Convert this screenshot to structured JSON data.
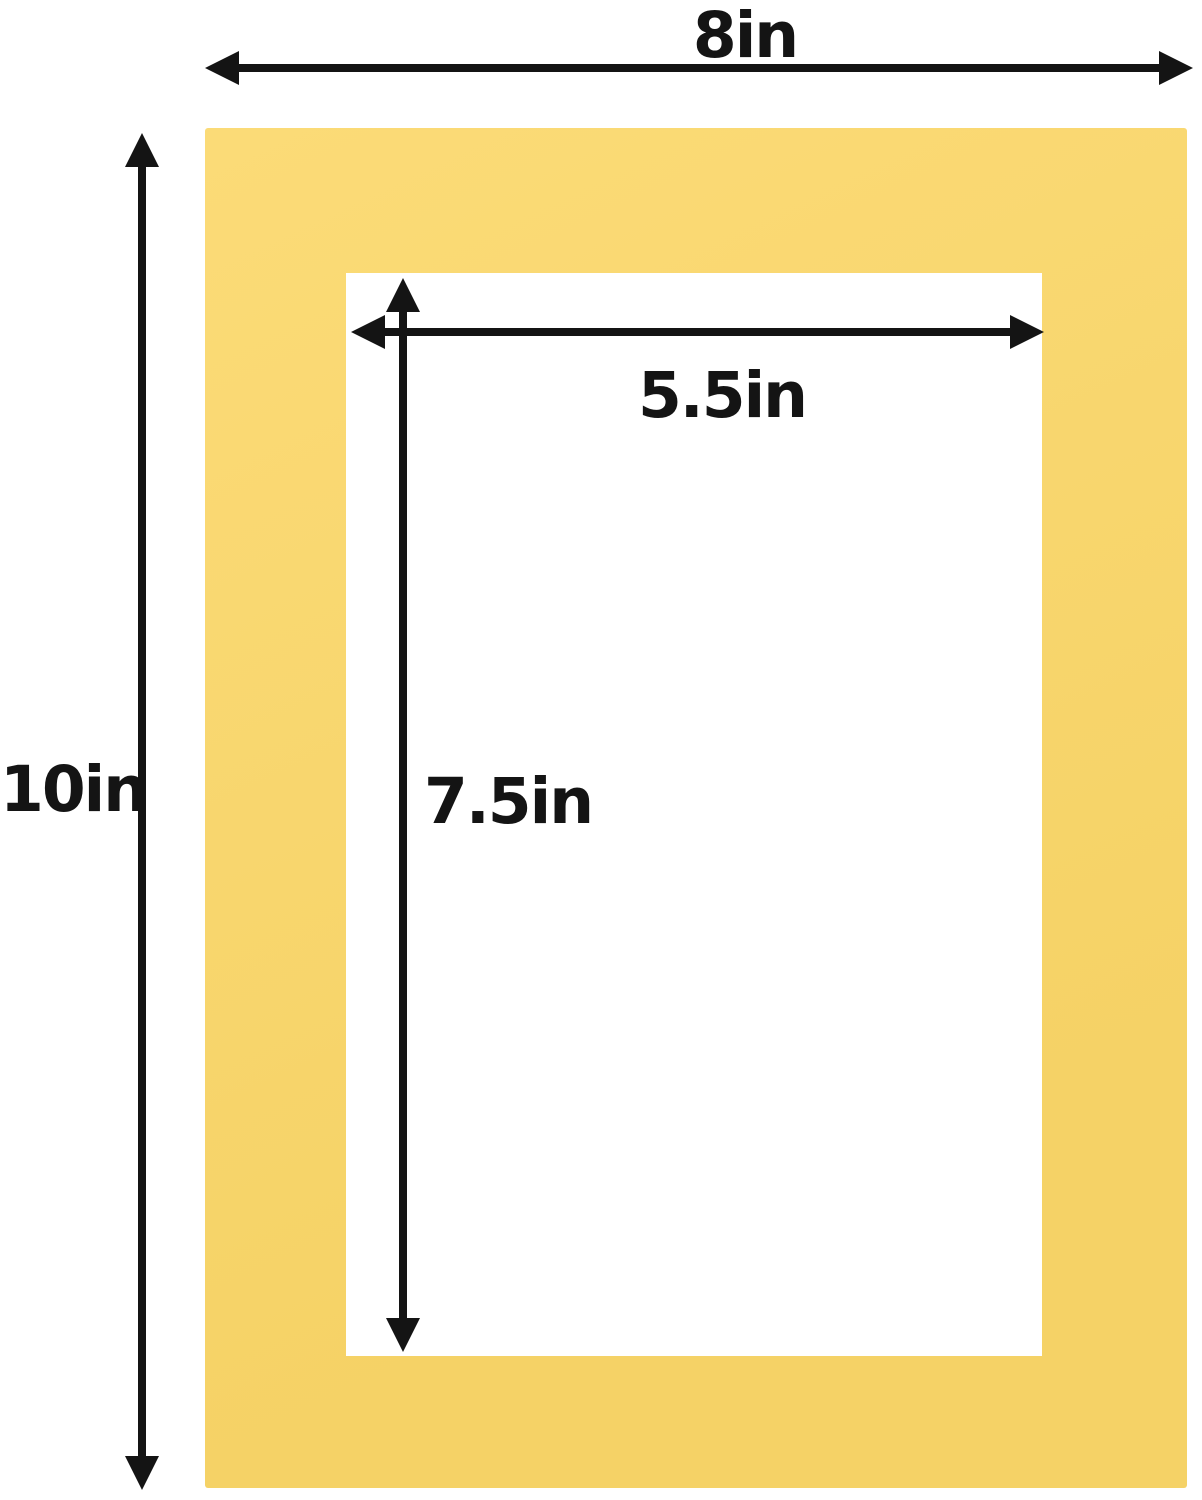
{
  "colors": {
    "background": "#ffffff",
    "mat": "#fbd768",
    "opening": "#ffffff",
    "arrow": "#141414",
    "text": "#141414"
  },
  "dimensions": {
    "outer_width": {
      "label": "8in",
      "inches": 8
    },
    "outer_height": {
      "label": "10in",
      "inches": 10
    },
    "opening_width": {
      "label": "5.5in",
      "inches": 5.5
    },
    "opening_height": {
      "label": "7.5in",
      "inches": 7.5
    }
  }
}
